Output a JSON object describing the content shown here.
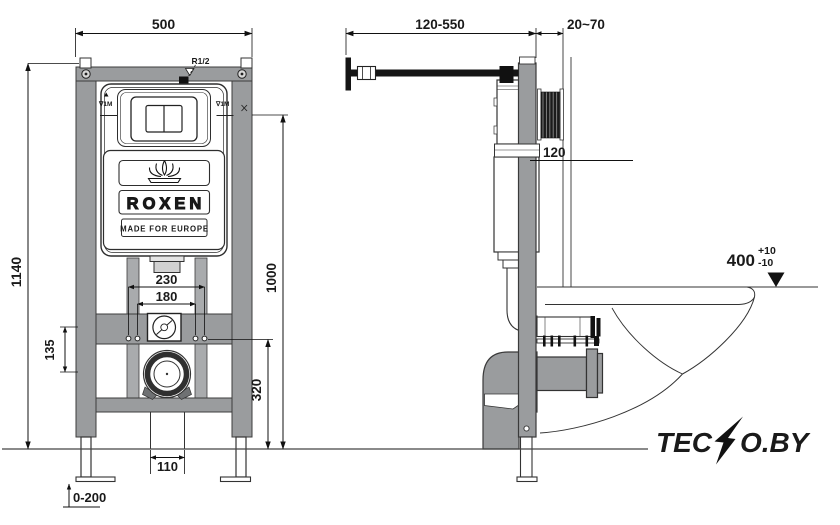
{
  "drawing": {
    "front": {
      "dim_width": "500",
      "dim_height": "1140",
      "dim_button_height": "1000",
      "dim_drain_height": "320",
      "dim_studs_outer": "230",
      "dim_studs_inner": "180",
      "dim_rail": "135",
      "dim_outlet": "110",
      "dim_feet": "0-200",
      "inlet": "R1/2",
      "water_mark": "∇1M"
    },
    "side": {
      "dim_bracket": "120-550",
      "dim_wall_gap": "20~70",
      "dim_depth": "120",
      "dim_bowl_height": "400",
      "dim_tol_plus": "+10",
      "dim_tol_minus": "-10"
    },
    "brand": {
      "name": "ROXEN",
      "tagline": "MADE FOR EUROPE"
    },
    "watermark": {
      "part1": "TEC",
      "part2": "O.BY",
      "color": "#f4731f"
    }
  }
}
